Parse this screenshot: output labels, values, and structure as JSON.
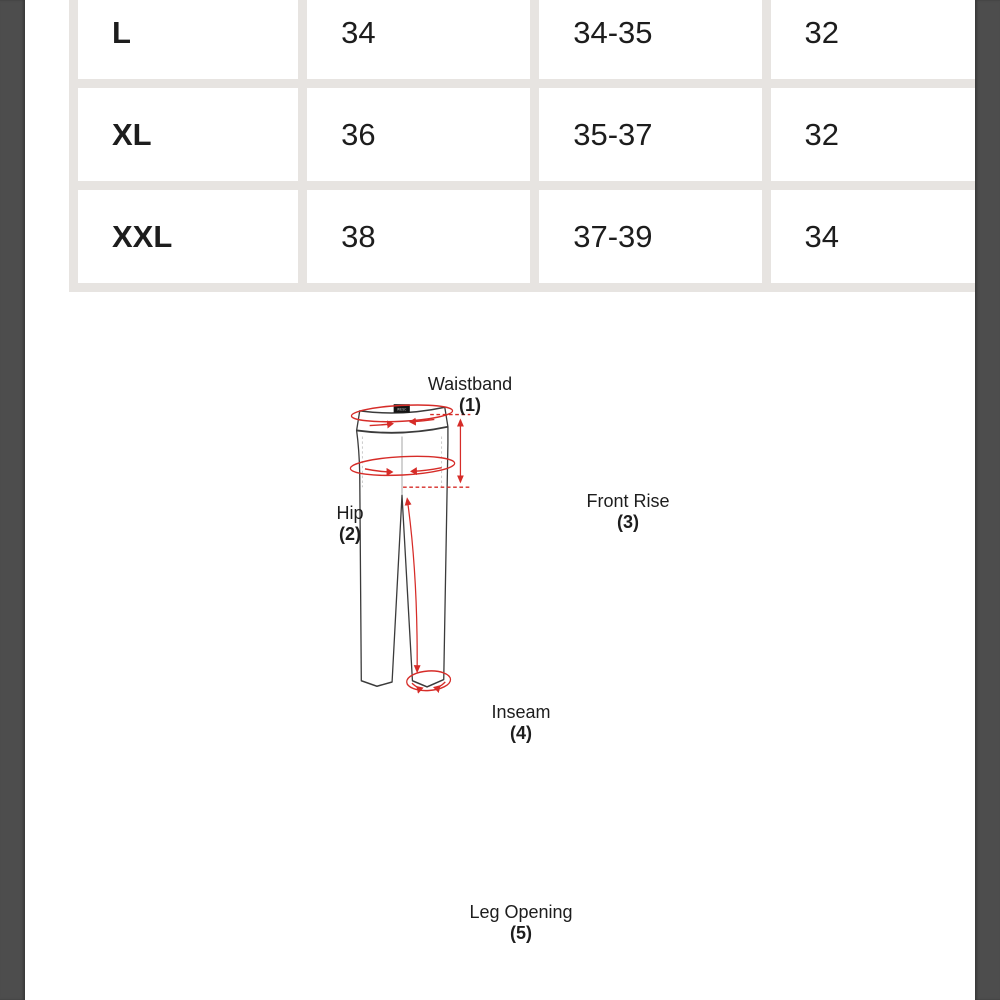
{
  "size_chart": {
    "rows": [
      {
        "size": "L",
        "col2": "34",
        "col3": "34-35",
        "col4": "32"
      },
      {
        "size": "XL",
        "col2": "36",
        "col3": "35-37",
        "col4": "32"
      },
      {
        "size": "XXL",
        "col2": "38",
        "col3": "37-39",
        "col4": "34"
      }
    ]
  },
  "diagram": {
    "brand_tag": "WESC",
    "labels": {
      "waistband": {
        "name": "Waistband",
        "number": "(1)"
      },
      "hip": {
        "name": "Hip",
        "number": "(2)"
      },
      "front_rise": {
        "name": "Front Rise",
        "number": "(3)"
      },
      "inseam": {
        "name": "Inseam",
        "number": "(4)"
      },
      "leg_opening": {
        "name": "Leg Opening",
        "number": "(5)"
      }
    }
  },
  "colors": {
    "measurement_red": "#d62c28",
    "pants_outline": "#3b3b3b",
    "table_grid": "#e7e4e1",
    "letterbox": "#4d4d4d",
    "text": "#1d1d1d"
  }
}
